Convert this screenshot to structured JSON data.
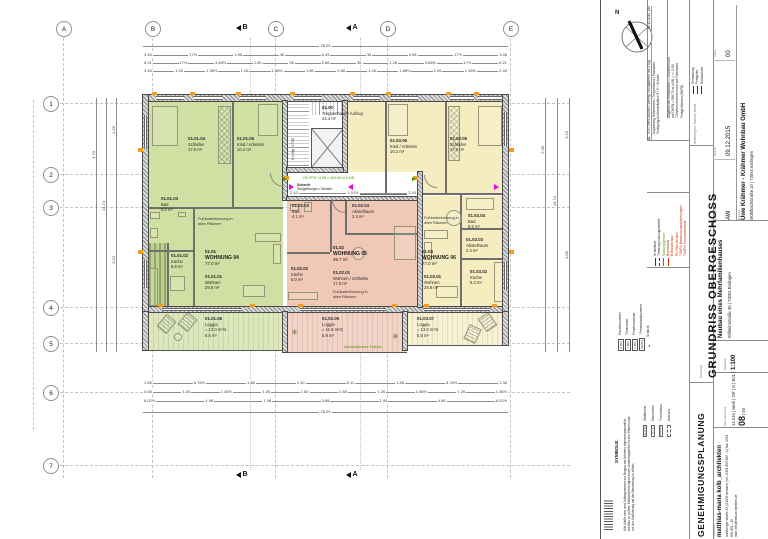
{
  "sheet": {
    "north_label": "N"
  },
  "axes": {
    "cols": [
      "A",
      "B",
      "C",
      "D",
      "E"
    ],
    "rows": [
      "1",
      "2",
      "3",
      "4",
      "5",
      "6",
      "7"
    ],
    "sections": {
      "top_b": "B",
      "top_a": "A",
      "bottom_b": "B",
      "bottom_a": "A"
    }
  },
  "plan": {
    "stair": {
      "id": "01.00",
      "name": "Treppenhaus / Aufzug",
      "area": "24.4 m²",
      "stair_note": "9 x Stg. 17/28"
    },
    "fbh_note": "Fußbodenheizung in allen Räumen",
    "shaft_label1": "Schacht",
    "shaft_label2": "Steigleitungen / Medien",
    "level_note": "OK FFB +4.88 = 343.63 m ü.NN",
    "fallrohr_note": "durchlaufendes Fallrohr",
    "apartments": [
      {
        "id": "01.01",
        "name": "WOHNUNG 04",
        "area": "77.0 m²",
        "rooms": [
          {
            "id": "01.01.01",
            "name": "Wohnen",
            "area": "29.6 m²"
          },
          {
            "id": "01.01.02",
            "name": "Küche",
            "area": "8.6 m²"
          },
          {
            "id": "01.01.03",
            "name": "Bad",
            "area": "5.0 m²"
          },
          {
            "id": "01.01.04",
            "name": "Schlafen",
            "area": "17.0 m²"
          },
          {
            "id": "01.01.05",
            "name": "Kind / Arbeiten",
            "area": "10.2 m²"
          },
          {
            "id": "01.01.06",
            "name": "Loggia",
            "calc": "= 13.0 m²/2",
            "area": "6.5 m²"
          }
        ]
      },
      {
        "id": "01.02",
        "name": "WOHNUNG 05",
        "area": "39.7 m²",
        "rooms": [
          {
            "id": "01.02.01",
            "name": "Wohnen / Schlafen",
            "area": "17.5 m²"
          },
          {
            "id": "01.02.02",
            "name": "Küche",
            "area": "5.0 m²"
          },
          {
            "id": "01.02.03",
            "name": "Bad",
            "area": "4.1 m²"
          },
          {
            "id": "01.02.04",
            "name": "Abstellraum",
            "area": "2.4 m²"
          },
          {
            "id": "01.02.05",
            "name": "Loggia",
            "calc": "= 11.8 m²/2",
            "area": "5.9 m²"
          }
        ]
      },
      {
        "id": "01.03",
        "name": "WOHNUNG 06",
        "area": "77.0 m²",
        "rooms": [
          {
            "id": "01.03.01",
            "name": "Wohnen",
            "area": "29.6 m²"
          },
          {
            "id": "01.03.02",
            "name": "Küche",
            "area": "5.3 m²"
          },
          {
            "id": "01.03.03",
            "name": "Abstellraum",
            "area": "2.4 m²"
          },
          {
            "id": "01.03.04",
            "name": "Bad",
            "area": "5.5 m²"
          },
          {
            "id": "01.03.05",
            "name": "Schlafen",
            "area": "17.0 m²"
          },
          {
            "id": "01.03.06",
            "name": "Kind / Arbeiten",
            "area": "10.2 m²"
          },
          {
            "id": "01.03.07",
            "name": "Loggia",
            "calc": "= 13.0 m²/2",
            "area": "6.5 m²"
          }
        ]
      }
    ]
  },
  "dims": {
    "top_r1": [
      "28.29"
    ],
    "top_r2": [
      "3.48",
      "17½",
      "4.98",
      "36",
      "6.43",
      "36",
      "4.98",
      "17½",
      "3.48"
    ],
    "top_r3": [
      "6.01",
      "17½",
      "3.68½",
      "1.80",
      "36",
      "5.88",
      "36",
      "1.26",
      "3.68½",
      "17½",
      "6.21"
    ],
    "top_r4": [
      "3.48",
      "1.26",
      "1.38½",
      "1.26",
      "1.88½",
      "1.80",
      "2.88",
      "1.26",
      "1.88½",
      "1.26",
      "1.38½",
      "2.45"
    ],
    "bot_r1": [
      "1.88",
      "6.78½",
      "1.88",
      "2.30",
      "8.11",
      "1.88",
      "6.78½",
      "1.38"
    ],
    "bot_r2": [
      "4.08",
      "1.26",
      "1.38½",
      "1.26",
      "1.80",
      "2.88",
      "1.26",
      "1.88½",
      "1.26",
      "1.38½"
    ],
    "bot_r3": [
      "6.02½",
      "4.98",
      "1.98",
      "5.88",
      "1.98",
      "4.98",
      "6.02½"
    ],
    "bot_r4": [
      "28.29"
    ],
    "corr": [
      "2.43",
      "1.01½",
      "2.43"
    ],
    "left": [
      "4.73",
      "14.74",
      "1.26",
      "3.23"
    ],
    "right": [
      "2.39",
      "14.74",
      "3.23",
      "4.86"
    ]
  },
  "titleblock": {
    "phase": "GENEHMIGUNGSPLANUNG",
    "title": "GRUNDRISS  OBERGESCHOSS",
    "title_label": "Planinhalt",
    "scale_label": "Maßstab",
    "scale": "1:100",
    "code_label": "Plan-Kennung",
    "code_pre": "14.016 | werk | GP | G | E01 |",
    "code_big": "08",
    "code_post": "| 00",
    "client_label": "Bauherr",
    "client_name": "Uwe Krähmer  -  Krähmer Wohnbau GmbH",
    "client_address": "Mühlbachstraße 10   |   73054 Eislingen",
    "drawn_label": "gezeichnet",
    "drawn": "AW",
    "date_label": "Datum",
    "date": "09.12.2015",
    "index_label": "Index",
    "index": "00",
    "project_label": "Projekt",
    "project_name": "Neubau eines Mehrfamilienhauses",
    "project_address": "Wilhelmstraße 36   |   73054 Eislingen",
    "architect_label": "Architekt",
    "architect_name": "matthias-maria kolb_architekten",
    "architect_address": "radeberger straße 43 | 01099 dresden | tel.: 0351 899 652 - 0 | fax: 0351 899 652 - 19",
    "architect_mail": "mail: info@mm-architekten.de",
    "revision": {
      "no": "01",
      "line1": "TEXTURPLANUNG:  Verring. Hochparterre um 2 Stg.",
      "line2": "Anpassung Höhenkoten / Treppenhaus / Fassaden",
      "line3": "Verlegung Außenstellplätze 8 / 9 + Zufahrt",
      "date": "09.12.2015",
      "by": "AW"
    },
    "rev_header": "Änderungen      |      Datum      |      Name",
    "height_notes": [
      "Angaben mit Höhenkoten +/- beziehen sich",
      "auf OKFB = 338.75 m ü.NN = +/- 0.00",
      "Türhöhen beziehen sich auf Oberkante",
      "Fertigfußboden (OKFB)"
    ],
    "marks_legend": [
      "Vermaßung",
      "Fertigkote",
      "Rohbaukote"
    ],
    "line_legend": [
      {
        "label": "Schnittlinie"
      },
      {
        "label": "Trennung Nutzungseinheit"
      },
      {
        "label": "Nutzungsgrenze"
      },
      {
        "label": "Brandwand"
      },
      {
        "label": "B     Brandschutz"
      },
      {
        "label": "RS    Rauchschutz"
      },
      {
        "label": "T30/RS   Brandschutzanforderungen /"
      },
      {
        "label": "T90/RS   Feuerwiderstand"
      }
    ],
    "symbols_header": "SYMBOLE:",
    "box_legend": [
      {
        "tag": "H B01",
        "label": "Haustürnummer"
      },
      {
        "tag": "T B01",
        "label": "Türnummer"
      },
      {
        "tag": "F B01",
        "label": "Fensternummer"
      },
      {
        "tag": "FB B01",
        "label": "Fensterbandnummer"
      },
      {
        "tag": "▲",
        "label": "Schacht"
      }
    ],
    "hatch_legend": [
      "Stahlbeton",
      "Mauerwerk",
      "Trockenbau",
      "Abbruch"
    ],
    "disclaimer": [
      "Alle Maße sind vom Auftragnehmer vor Beginn der Arbeiten eigenverantwortlich",
      "am Bau zu prüfen. Maßabweichungen sowie Unstimmigkeiten in den Plänen sind",
      "vor der Ausführung mit der Bauleitung zu klären."
    ]
  },
  "colors": {
    "apartment_green": "#cfe0a2",
    "loggia_green": "#dce8bb",
    "apartment_pink": "#f1c7b6",
    "loggia_pink": "#f3d3c5",
    "apartment_yellow": "#f5ecc0",
    "loggia_yellow": "#f7f1d2",
    "accent_orange": "#f49b20",
    "accent_magenta": "#e800e8",
    "annotation_green": "#3f9b00",
    "legend_red": "#cc2a00"
  }
}
